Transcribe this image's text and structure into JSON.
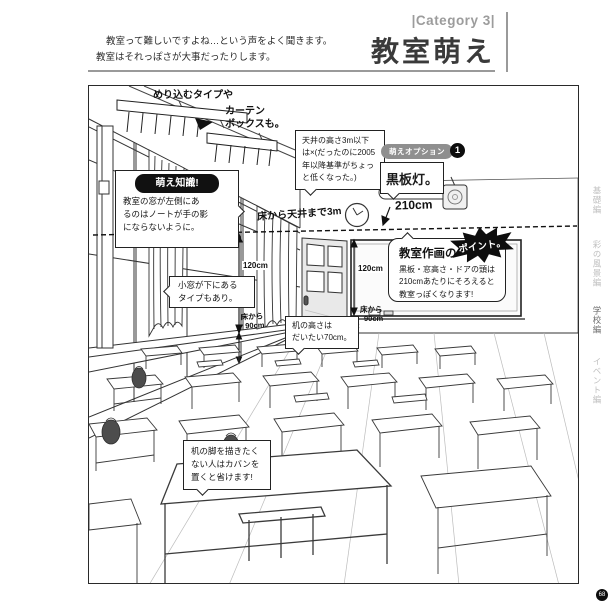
{
  "header": {
    "category": "|Category 3|",
    "title": "教室萌え"
  },
  "intro": {
    "line1": "教室って難しいですよね…という声をよく聞きます。",
    "line2": "教室はそれっぽさが大事だったりします。"
  },
  "callouts": {
    "curtain": {
      "title": "めり込むタイプや",
      "note_line1": "カーテン",
      "note_line2": "ボックスも。"
    },
    "knowledge": {
      "badge": "萌え知識!",
      "line1": "教室の窓が左側にあ",
      "line2": "るのはノートが手の影",
      "line3": "にならないように。"
    },
    "ceiling": {
      "line1": "天井の高さ3m以下",
      "line2": "は×(だったのに2005",
      "line3": "年以降基準がちょっ",
      "line4": "と低くなった。)"
    },
    "option": {
      "badge": "萌えオプション",
      "number": "1",
      "label": "黒板灯。"
    },
    "point": {
      "title": "教室作画の",
      "burst": "ポイント。",
      "line1": "黒板・窓高さ・ドアの頭は",
      "line2": "210cmあたりにそろえると",
      "line3": "教室っぽくなります!"
    },
    "small_window": {
      "line1": "小窓が下にある",
      "line2": "タイプもあり。"
    },
    "desk_height": {
      "line1": "机の高さは",
      "line2": "だいたい70cm。"
    },
    "desk_legs": {
      "line1": "机の脚を描きたく",
      "line2": "ない人はカバンを",
      "line3": "置くと省けます!"
    }
  },
  "measurements": {
    "ceiling_total": "床から天井まで3m",
    "line_210": "210cm",
    "height_120": "120cm",
    "from_floor": "床から",
    "ninety": "90cm"
  },
  "sidebar": {
    "tabs": [
      {
        "label": "基礎編"
      },
      {
        "label": "彩の風景編"
      },
      {
        "label": "学校編"
      },
      {
        "label": "イベント編"
      }
    ]
  },
  "page_number": "68",
  "colors": {
    "ink": "#2a2a2a",
    "badge_black": "#111111",
    "badge_gray": "#8f8f8f",
    "rule_gray": "#9a9a9a"
  }
}
